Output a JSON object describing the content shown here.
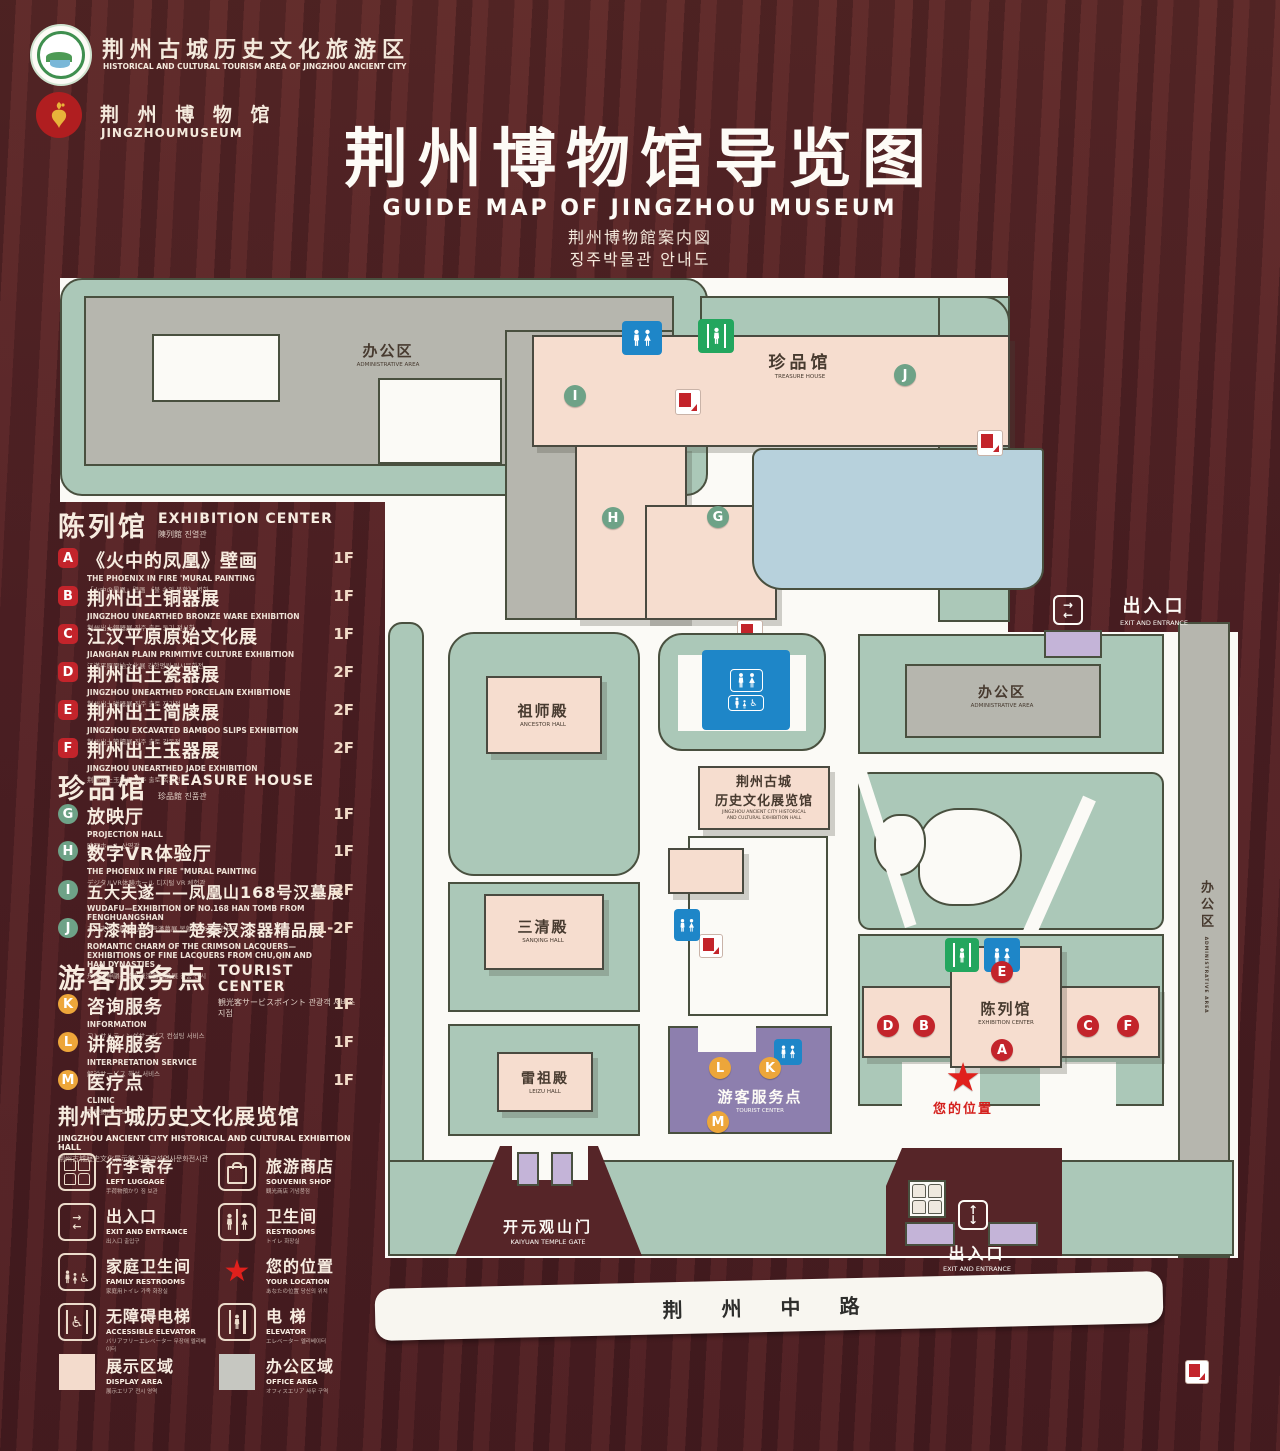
{
  "header": {
    "brand1_zh": "荆州古城历史文化旅游区",
    "brand1_en": "HISTORICAL AND CULTURAL TOURISM AREA OF JINGZHOU ANCIENT CITY",
    "brand2_zh": "荆 州 博 物 馆",
    "brand2_en": "JINGZHOUMUSEUM",
    "title_zh": "荆州博物馆导览图",
    "title_en": "GUIDE MAP OF JINGZHOU MUSEUM",
    "title_ja": "荆州博物館案内図",
    "title_ko": "징주박물관 안내도"
  },
  "panel": {
    "sections": [
      {
        "zh": "陈列馆",
        "en": "EXHIBITION CENTER",
        "sub": "陳列館  진열관",
        "items": [
          {
            "id": "A",
            "zh": "《火中的凤凰》壁画",
            "en": "THE PHOENIX IN FIRE 'MURAL PAINTING",
            "sub": "「火中の鳳凰」壁画 《불 속의 봉황》 벽화",
            "floor": "1F"
          },
          {
            "id": "B",
            "zh": "荆州出土铜器展",
            "en": "JINGZHOU UNEARTHED BRONZE WARE EXHIBITION",
            "sub": "荆州出土銅器展  징주 출토 동기 전시회",
            "floor": "1F"
          },
          {
            "id": "C",
            "zh": "江汉平原原始文化展",
            "en": "JIANGHAN PLAIN PRIMITIVE CULTURE EXHIBITION",
            "sub": "江漢平原原始文化展  강한평원 원시문화전",
            "floor": "1F"
          },
          {
            "id": "D",
            "zh": "荆州出土瓷器展",
            "en": "JINGZHOU UNEARTHED PORCELAIN EXHIBITIONE",
            "sub": "荆州出土磁器展  징주 출토 자기전",
            "floor": "2F"
          },
          {
            "id": "E",
            "zh": "荆州出土简牍展",
            "en": "JINGZHOU EXCAVATED BAMBOO SLIPS EXHIBITION",
            "sub": "荆州出土簡牘展  징주 출토 간독전",
            "floor": "2F"
          },
          {
            "id": "F",
            "zh": "荆州出土玉器展",
            "en": "JINGZHOU UNEARTHED JADE EXHIBITION",
            "sub": "荆州出土玉器展  징주 출토 옥기전",
            "floor": "2F"
          }
        ]
      },
      {
        "zh": "珍品馆",
        "en": "TREASURE HOUSE",
        "sub": "珍品館  진품관",
        "items": [
          {
            "id": "G",
            "zh": "放映厅",
            "en": "PROJECTION HALL",
            "sub": "映写ホール  상영관",
            "floor": "1F"
          },
          {
            "id": "H",
            "zh": "数字VR体验厅",
            "en": "THE PHOENIX IN FIRE \"MURAL PAINTING",
            "sub": "デジタルVR体験ホール  디지털 VR 체험관",
            "floor": "1F"
          },
          {
            "id": "I",
            "zh": "五大夫遂——凤凰山168号汉墓展",
            "en": "WUDAFU—EXHIBITION OF NO.168 HAN TOMB FROM FENGHUANGSHAN",
            "sub": "五大夫遂—鳳凰山168号漢墓展  봉황산 168호 한묘전",
            "floor": "2F"
          },
          {
            "id": "J",
            "zh": "丹漆神韵——楚秦汉漆器精品展",
            "en": "ROMANTIC CHARM OF THE CRIMSON LACQUERS— EXHIBITIONS OF FINE LACQUERS FROM CHU,QIN AND HAN DYNASTIES",
            "sub": "丹漆の神韻—楚秦漢漆器精品展  진품 전시",
            "floor": "1-2F"
          }
        ]
      },
      {
        "zh": "游客服务点",
        "en": "TOURIST CENTER",
        "sub": "観光客サービスポイント  관광객 서비스 지점",
        "items": [
          {
            "id": "K",
            "zh": "咨询服务",
            "en": "INFORMATION",
            "sub": "コンサルティングサービス  컨설팅 서비스",
            "floor": "1F"
          },
          {
            "id": "L",
            "zh": "讲解服务",
            "en": "INTERPRETATION SERVICE",
            "sub": "解説サービス  해설 서비스",
            "floor": "1F"
          },
          {
            "id": "M",
            "zh": "医疗点",
            "en": "CLINIC",
            "sub": "医療拠点  의료점",
            "floor": "1F"
          }
        ]
      }
    ],
    "hall": {
      "zh": "荆州古城历史文化展览馆",
      "en": "JINGZHOU ANCIENT CITY HISTORICAL AND CULTURAL EXHIBITION HALL",
      "sub": "荆州古城歴史文化展示館   징주고성역사문화전시관"
    },
    "legend": [
      {
        "icon": "left-luggage",
        "zh": "行李寄存",
        "en": "LEFT LUGGAGE",
        "sub": "手荷物預かり  짐 보관"
      },
      {
        "icon": "souvenir-shop",
        "zh": "旅游商店",
        "en": "SOUVENIR SHOP",
        "sub": "観光商店  기념품점"
      },
      {
        "icon": "exit-entrance",
        "zh": "出入口",
        "en": "EXIT AND ENTRANCE",
        "sub": "出入口  출입구"
      },
      {
        "icon": "restrooms",
        "zh": "卫生间",
        "en": "RESTROOMS",
        "sub": "トイレ  화장실"
      },
      {
        "icon": "family-restrooms",
        "zh": "家庭卫生间",
        "en": "FAMILY RESTROOMS",
        "sub": "家庭用トイレ  가족 화장실"
      },
      {
        "icon": "your-location",
        "zh": "您的位置",
        "en": "YOUR LOCATION",
        "sub": "あなたの位置  당신의 위치"
      },
      {
        "icon": "accessible-elevator",
        "zh": "无障碍电梯",
        "en": "ACCESSIBLE ELEVATOR",
        "sub": "バリアフリーエレベーター  무장애 엘리베이터"
      },
      {
        "icon": "elevator",
        "zh": "电  梯",
        "en": "ELEVATOR",
        "sub": "エレベーター  엘리베이터"
      },
      {
        "icon": "display-area",
        "zh": "展示区域",
        "en": "DISPLAY AREA",
        "sub": "展示エリア  전시 영역",
        "swatch": "#f3dbcc"
      },
      {
        "icon": "office-area",
        "zh": "办公区域",
        "en": "OFFICE AREA",
        "sub": "オフィスエリア  사무 구역",
        "swatch": "#c6c7c1"
      }
    ]
  },
  "map": {
    "admin_nw_zh": "办公区",
    "admin_nw_en": "ADMINISTRATIVE AREA",
    "treasure_zh": "珍品馆",
    "treasure_en": "TREASURE HOUSE",
    "ancestor_zh": "祖师殿",
    "ancestor_en": "ANCESTOR HALL",
    "sanqing_zh": "三清殿",
    "sanqing_en": "SANQING HALL",
    "leizu_zh": "雷祖殿",
    "leizu_en": "LEIZU HALL",
    "hall_zh1": "荆州古城",
    "hall_zh2": "历史文化展览馆",
    "hall_en1": "JINGZHOU ANCIENT CITY HISTORICAL",
    "hall_en2": "AND CULTURAL EXHIBITION HALL",
    "admin_mid_zh": "办公区",
    "admin_mid_en": "ADMINISTRATIVE AREA",
    "admin_right_zh": "办公区",
    "admin_right_en": "ADMINISTRATIVE AREA",
    "excenter_zh": "陈列馆",
    "excenter_en": "EXHIBITION CENTER",
    "tourist_zh": "游客服务点",
    "tourist_en": "TOURIST CENTER",
    "exit_zh": "出入口",
    "exit_en": "EXIT AND ENTRANCE",
    "gate_zh": "开元观山门",
    "gate_en": "KAIYUAN TEMPLE GATE",
    "road_zh": "荆 州 中 路",
    "location_zh": "您的位置",
    "markers": {
      "green": [
        "I",
        "J",
        "H",
        "G"
      ],
      "red": [
        "E",
        "D",
        "B",
        "A",
        "C",
        "F"
      ],
      "orange": [
        "L",
        "K",
        "M"
      ]
    }
  },
  "colors": {
    "wood": "#552327",
    "mint": "#abc8b8",
    "building_gray": "#b6b6ae",
    "building_pink": "#f6ddcf",
    "lake": "#b7d1dc",
    "tourist_purple": "#8d7fae",
    "purple_light": "#c4b4d8",
    "road": "#f8f6f0",
    "marker_red": "#c3242b",
    "marker_green": "#6ea287",
    "marker_orange": "#eda63a",
    "restroom_blue": "#1e86c8",
    "exit_green": "#23a65e",
    "location_red": "#e0201c"
  }
}
